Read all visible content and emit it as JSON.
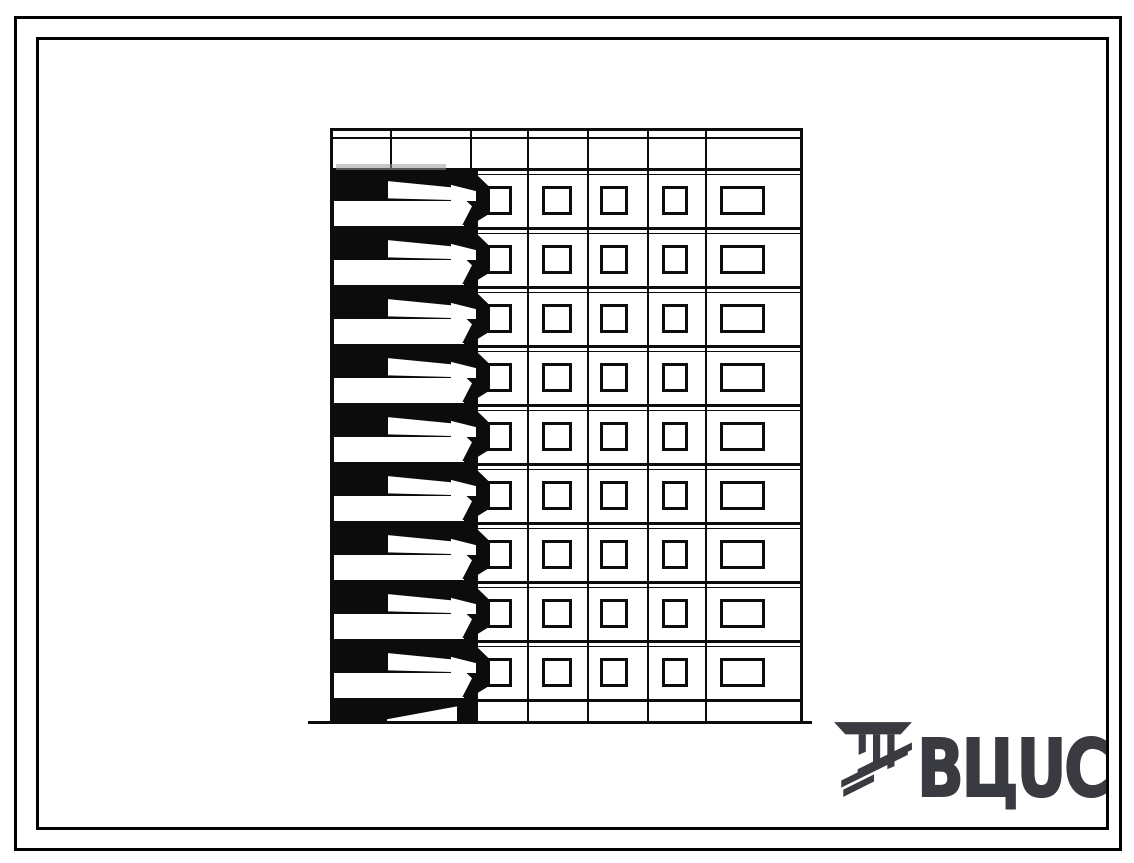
{
  "sheet": {
    "background": "#ffffff",
    "width": 1134,
    "height": 863
  },
  "frames": {
    "outer": {
      "x": 14,
      "y": 16,
      "w": 1108,
      "h": 835,
      "stroke": 3.5,
      "color": "#000000"
    },
    "inner": {
      "x": 36,
      "y": 37,
      "w": 1073,
      "h": 793,
      "stroke": 3,
      "color": "#000000"
    }
  },
  "logo": {
    "text": "ВЦUС",
    "color": "#3a3b41",
    "emblem": "vcis-columns-emblem",
    "x": 831,
    "y": 720,
    "text_x": 86,
    "text_y": 10,
    "font_size": 79
  },
  "elevation": {
    "type": "building-facade-elevation",
    "description": "nine-storey panel building end elevation with left balcony stack",
    "ink": "#0d0d0d",
    "balcony_fill": "#0c0c0c",
    "smudge": "#999999",
    "x": 330,
    "y": 128,
    "width": 473,
    "body_height": 571,
    "plinth_height": 25,
    "parapet_height": 40,
    "parapet_second_line_y": 9,
    "floor_height": 59,
    "floors": 9,
    "bay_lines": [
      60,
      140,
      197,
      257,
      317,
      375
    ],
    "line_w": 2.2,
    "slab_h": 2.5,
    "window_columns": [
      {
        "x": 154,
        "w": 28
      },
      {
        "x": 212,
        "w": 30
      },
      {
        "x": 270,
        "w": 28
      },
      {
        "x": 332,
        "w": 26
      },
      {
        "x": 390,
        "w": 45
      }
    ],
    "window": {
      "top": 18,
      "h": 29,
      "border": 3
    },
    "balcony": {
      "bg_x": 2,
      "bg_w": 146,
      "bulge_x": 146,
      "bulge_w": 14,
      "bulge_y": 6,
      "bulge_h": 48,
      "rail1_x": 58,
      "rail1_w": 64,
      "rail1_y": 11,
      "rail1_h": 21,
      "rail2_x": 121,
      "rail2_w": 25,
      "rail2_y": 16,
      "rail2_h": 17,
      "bar_x": 4,
      "bar_w": 138,
      "bar_y": 33,
      "bar_h": 24,
      "under_x": 4,
      "under_w": 130,
      "under_y": 56.5,
      "under_h": 1.6
    },
    "plinth_wedge": {
      "x": 57,
      "w": 70,
      "y": 7,
      "h": 17
    },
    "ground_line": {
      "x1": -22,
      "x2": 482,
      "h": 3.2
    }
  }
}
